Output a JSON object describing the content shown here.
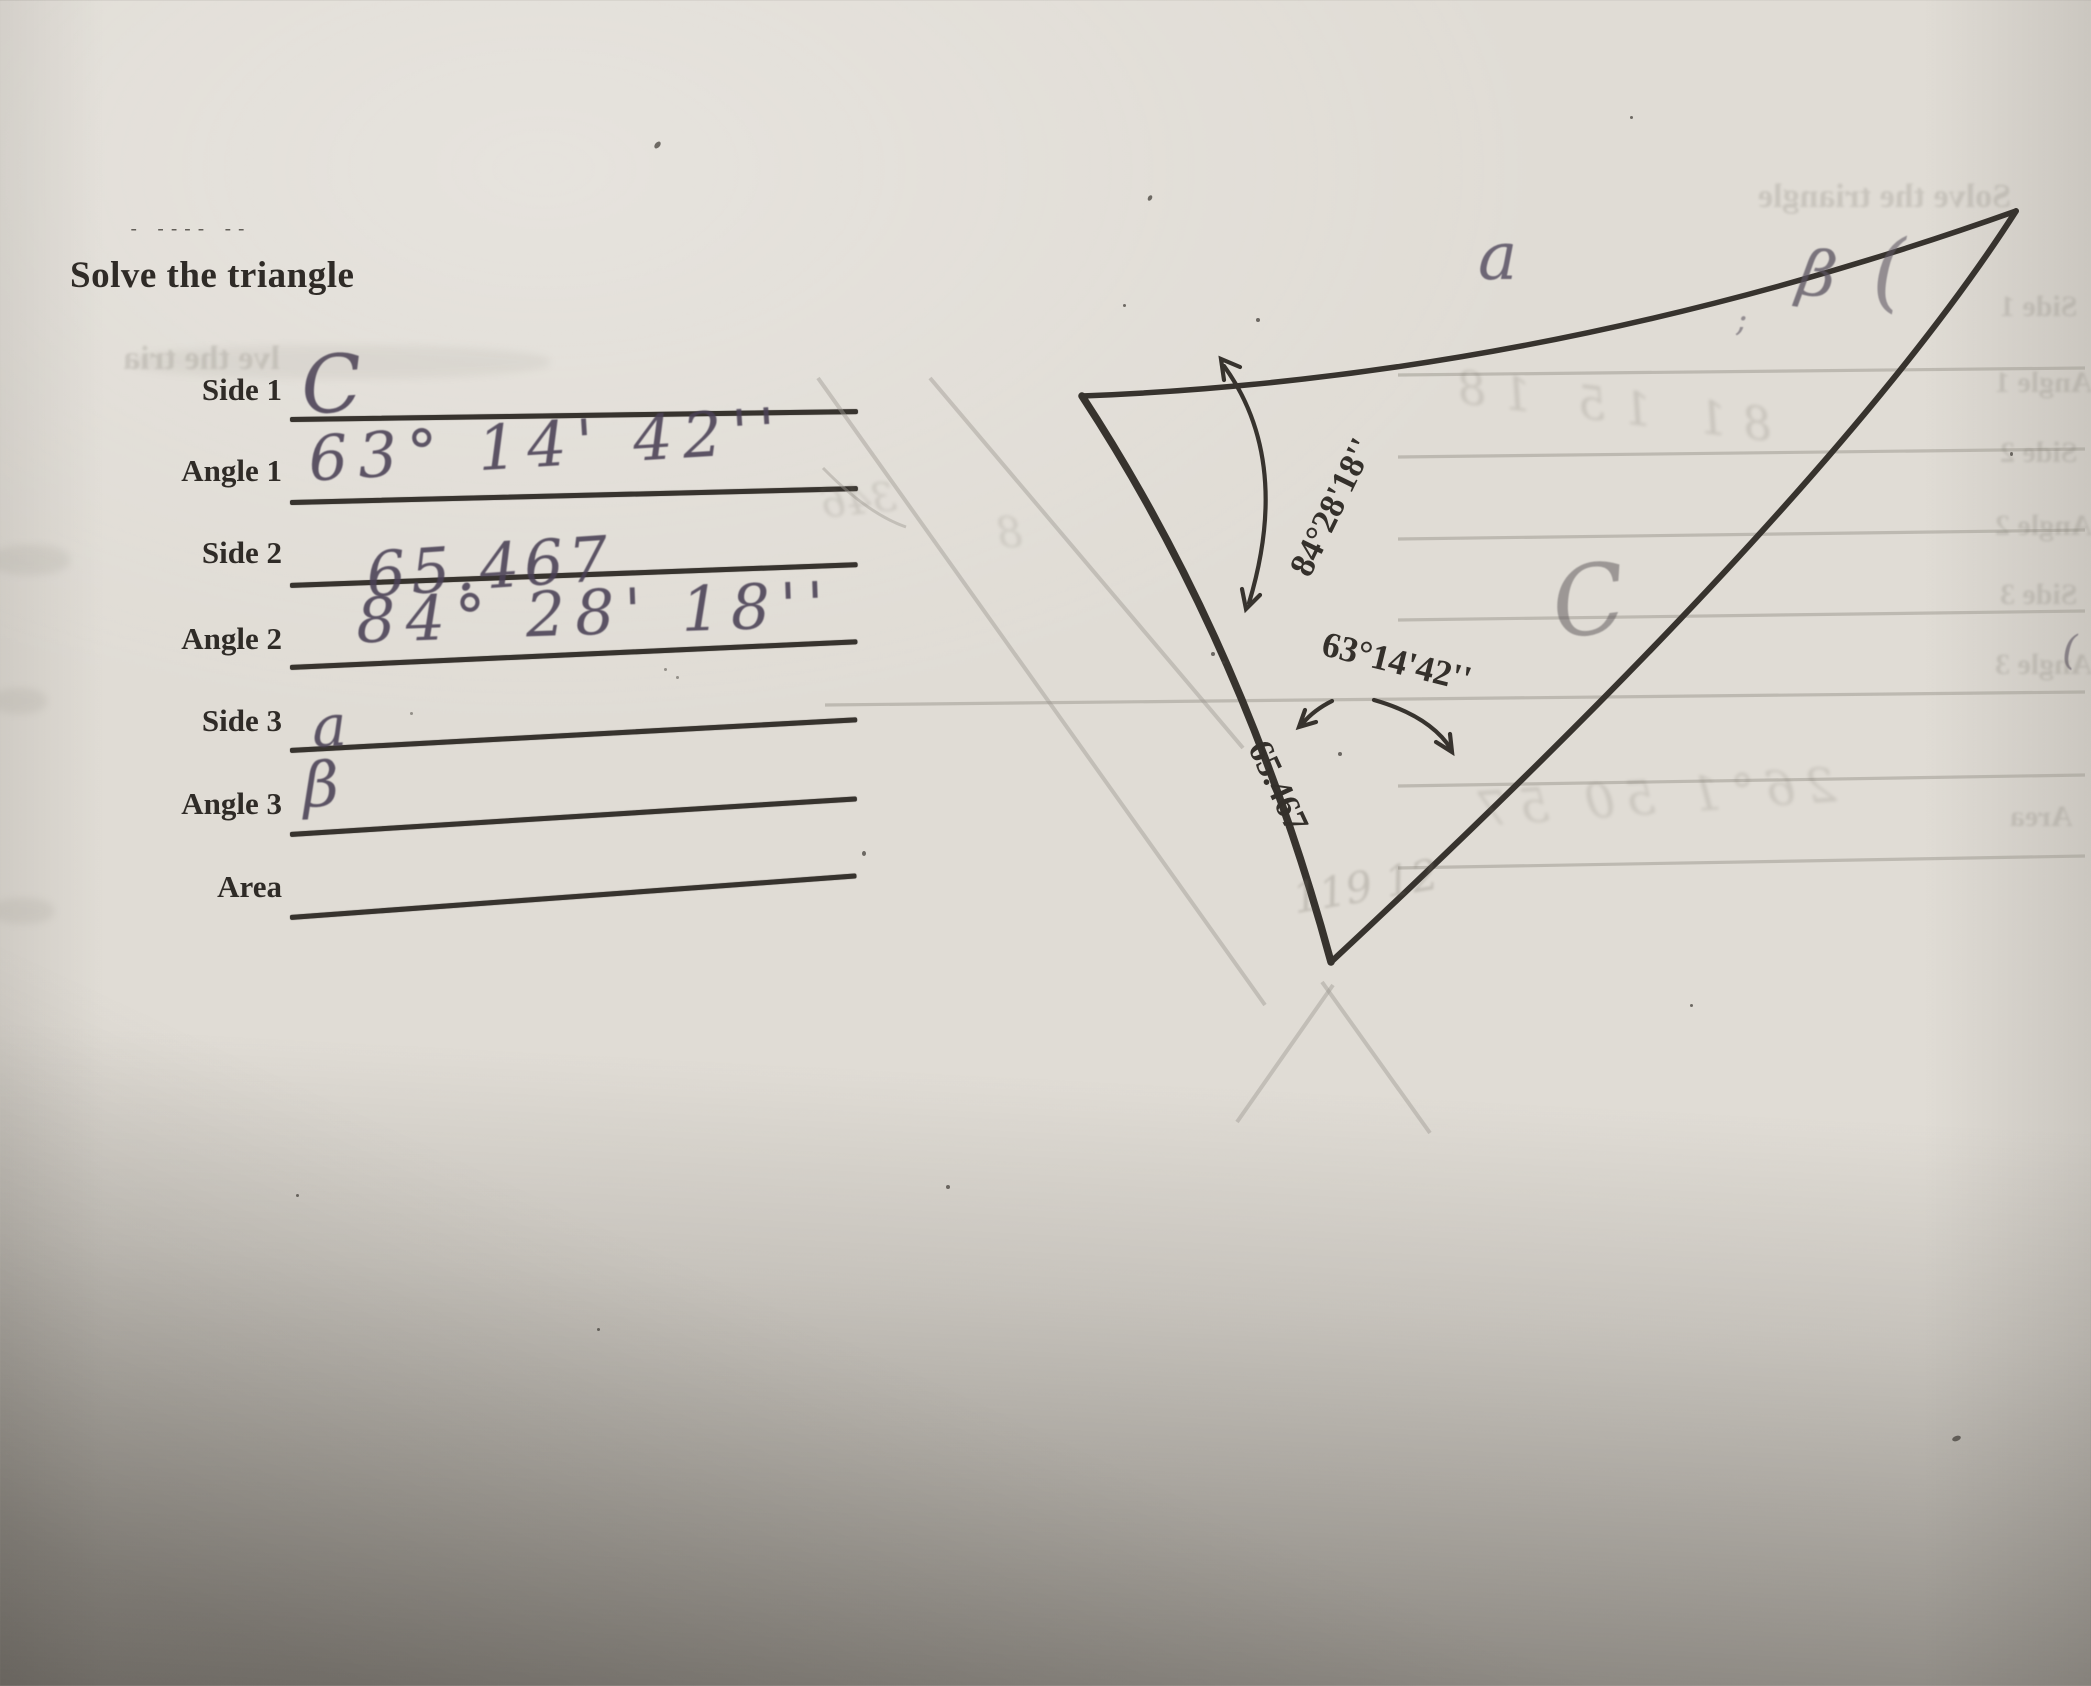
{
  "page": {
    "title": "Solve the triangle",
    "artifact_dashes": "- ---- --"
  },
  "form": {
    "rows": [
      {
        "label": "Side 1",
        "value": "C"
      },
      {
        "label": "Angle 1",
        "value": "63° 14' 42''"
      },
      {
        "label": "Side 2",
        "value": "65.467"
      },
      {
        "label": "Angle 2",
        "value": "84° 28' 18''"
      },
      {
        "label": "Side 3",
        "value": "a"
      },
      {
        "label": "Angle 3",
        "value": "β"
      },
      {
        "label": "Area",
        "value": ""
      }
    ]
  },
  "diagram": {
    "angle_top_left": "84°28'18''",
    "angle_bottom": "63°14'42''",
    "side_left_length": "65.467",
    "pencil_label_top": "a",
    "pencil_label_right": "β",
    "pencil_paren": "(",
    "pencil_letter_c": "C",
    "pencil_tick": ";",
    "pencil_edge_mark": "("
  },
  "ghosts": {
    "title_mirrored": "Solve the triangle",
    "title_fragment_left": "lve the tria",
    "form_labels_mirrored": [
      "Side 1",
      "Angle 1",
      "Side 2",
      "Angle 2",
      "Side 3",
      "Angle 3",
      "Area"
    ],
    "handwriting_upper": "81 15 18",
    "handwriting_lower": "26°1 50 57",
    "handwriting_bottom": "119 12",
    "handwriting_left": "346",
    "handwriting_digit": "8"
  },
  "colors": {
    "paper": "#e0dcd5",
    "toner": "#2f2b27",
    "pencil": "#4a4254",
    "shadow": "#8e8a83"
  }
}
